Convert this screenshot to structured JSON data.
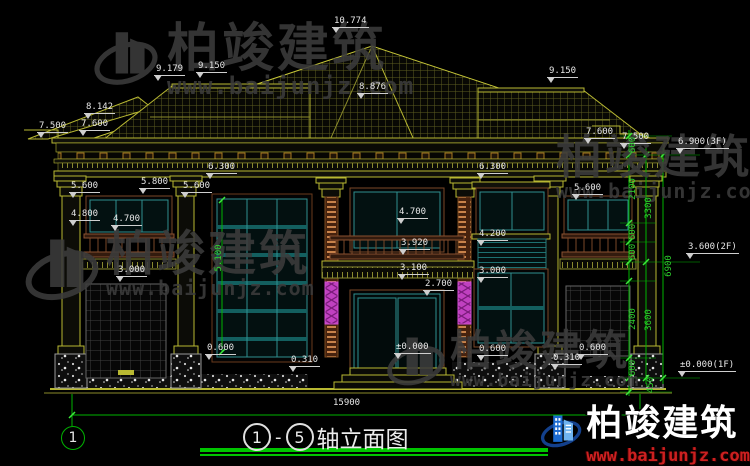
{
  "watermark": {
    "brand": "柏竣建筑",
    "site": "www.baijunjz.com"
  },
  "title": {
    "axis_start": "1",
    "dash": "-",
    "axis_end": "5",
    "text": "轴立面图"
  },
  "axis_bubble": {
    "left": "1"
  },
  "bottom_dim": {
    "total_width": "15900"
  },
  "labels": [
    {
      "t": "10.774"
    },
    {
      "t": "9.179"
    },
    {
      "t": "9.150"
    },
    {
      "t": "8.876"
    },
    {
      "t": "9.150"
    },
    {
      "t": "8.142"
    },
    {
      "t": "7.500"
    },
    {
      "t": "7.600"
    },
    {
      "t": "7.600"
    },
    {
      "t": "7.500"
    },
    {
      "t": "6.900(3F)"
    },
    {
      "t": "6.300"
    },
    {
      "t": "6.300"
    },
    {
      "t": "5.600"
    },
    {
      "t": "5.800"
    },
    {
      "t": "5.600"
    },
    {
      "t": "5.600"
    },
    {
      "t": "4.800"
    },
    {
      "t": "4.700"
    },
    {
      "t": "4.700"
    },
    {
      "t": "3.920"
    },
    {
      "t": "3.100"
    },
    {
      "t": "2.700"
    },
    {
      "t": "4.200"
    },
    {
      "t": "3.000"
    },
    {
      "t": "3.000"
    },
    {
      "t": "0.600"
    },
    {
      "t": "0.310"
    },
    {
      "t": "±0.000"
    },
    {
      "t": "0.600"
    },
    {
      "t": "0.310"
    },
    {
      "t": "0.600"
    },
    {
      "t": "3.600(2F)"
    },
    {
      "t": "±0.000(1F)"
    }
  ],
  "vdims": [
    {
      "t": "600"
    },
    {
      "t": "2100"
    },
    {
      "t": "3300"
    },
    {
      "t": "600"
    },
    {
      "t": "600"
    },
    {
      "t": "6900"
    },
    {
      "t": "2400"
    },
    {
      "t": "3600"
    },
    {
      "t": "600"
    },
    {
      "t": "450"
    },
    {
      "t": "5.100"
    }
  ],
  "colors": {
    "cad_yellow": "#b8b832",
    "dim_green": "#00b400",
    "window_teal": "#2f9090",
    "wood_brown": "#7a4828",
    "accent_magenta": "#c040c0",
    "logo_blue": "#1b6ad0"
  }
}
